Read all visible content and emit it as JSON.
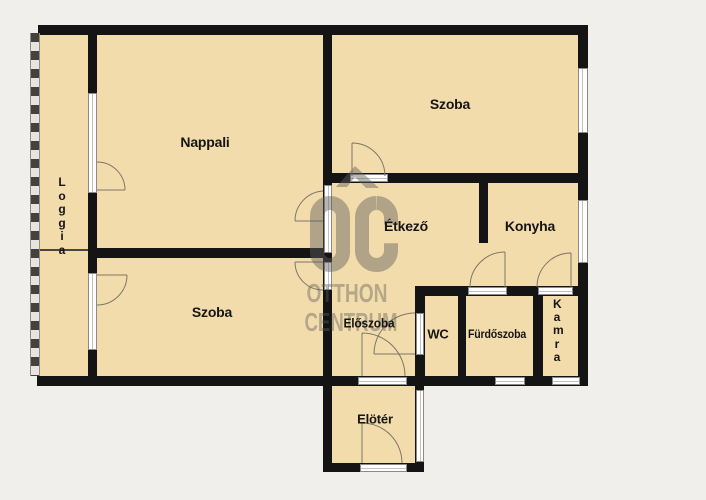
{
  "watermark": {
    "logo": "OC",
    "line1": "OTTHON",
    "line2": "CENTRUM"
  },
  "rooms": {
    "nappali": {
      "label": "Nappali"
    },
    "szoba_top": {
      "label": "Szoba"
    },
    "szoba_bottom": {
      "label": "Szoba"
    },
    "etkezo": {
      "label": "Étkező"
    },
    "konyha": {
      "label": "Konyha"
    },
    "eloszoba": {
      "label": "Előszoba"
    },
    "wc": {
      "label": "WC"
    },
    "furdoszoba": {
      "label": "Fürdőszoba"
    },
    "kamra": {
      "label": "Kamra"
    },
    "loggia": {
      "label": "Loggia"
    },
    "eloter": {
      "label": "Elötér"
    }
  },
  "colors": {
    "floor": "#f3dcab",
    "wall": "#141414",
    "background": "#f0efec",
    "window_white": "#ffffff",
    "watermark_gray": "rgba(96,94,92,0.48)",
    "door_arc": "#7d7668"
  }
}
